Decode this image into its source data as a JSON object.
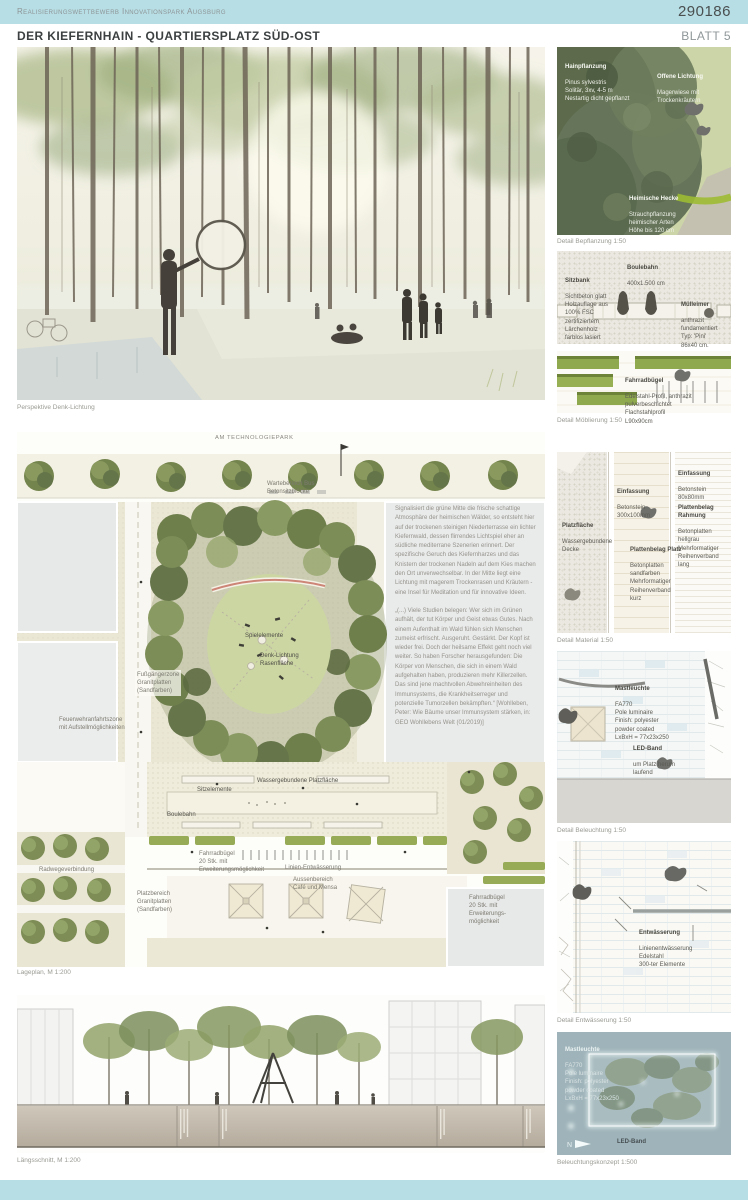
{
  "header": {
    "competition": "Realisierungswettbewerb Innovationspark Augsburg",
    "entry_number": "290186",
    "title": "DER KIEFERNHAIN - QUARTIERSPLATZ SÜD-OST",
    "sheet": "BLATT 5"
  },
  "perspective": {
    "caption": "Perspektive Denk-Lichtung"
  },
  "siteplan": {
    "street_label": "AM TECHNOLOGIEPARK",
    "caption": "Lageplan, M 1:200",
    "labels": {
      "wartebereich": "Wartebereich Bus\nBetonsitzblöcke",
      "spielelemente": "Spielelemente",
      "denklichtung": "Denk-Lichtung\nRasenfläche",
      "fussgaengerzone": "Fußgängerzone\nGranitplatten\n(Sandfarben)",
      "feuerwehr": "Feuerwehranfahrtszone\nmit Aufstellmöglichkeiten",
      "wassergebunden": "Wassergebundene Platzfläche",
      "sitzelemente": "Sitzelemente",
      "boulebahn": "Boulebahn",
      "fahrradbuegel_links": "Fahrradbügel\n20 Stk. mit\nErweiterungsmöglichkeit",
      "linienentwaesserung": "Linien-Entwässerung",
      "aussenbereich": "Aussenbereich\nCafé und Mensa",
      "platzbereich": "Platzbereich\nGranitplatten\n(Sandfarben)",
      "fahrradbuegel_rechts": "Fahrradbügel\n20 Stk. mit\nErweiterungs-\nmöglichkeit",
      "radweg": "Radwegeverbindung"
    },
    "text": {
      "p1": "Signalisiert die grüne Mitte die frische schattige Atmosphäre der heimischen Wälder, so entsteht hier auf der trockenen steinigen Niederterrasse ein lichter Kiefernwald, dessen flirrendes Lichtspiel eher an südliche mediterrane Szenerien erinnert. Der spezifische Geruch des Kiefernharzes und das Knistern der trockenen Nadeln auf dem Kies machen den Ort unverwechselbar. In der Mitte liegt eine Lichtung mit magerem Trockenrasen und Kräutern - eine Insel für Meditation und für innovative Ideen.",
      "p2": "„(...) Viele Studien belegen: Wer sich im Grünen aufhält, der tut Körper und Geist etwas Gutes. Nach einem Aufenthalt im Wald fühlen sich Menschen zumeist erfrischt. Ausgeruht. Gestärkt. Der Kopf ist wieder frei. Doch der heilsame Effekt geht noch viel weiter. So haben Forscher herausgefunden: Die Körper von Menschen, die sich in einem Wald aufgehalten haben, produzieren mehr Killerzellen. Das sind jene machtvollen Abwehreinheiten des Immunsystems, die Krankheitserreger und potenzielle Tumorzellen bekämpften.“ [Wohlleben, Peter: Wie Bäume unser Immunsystem stärken, in: GEO Wohllebens Welt (01/2019)]"
    }
  },
  "section": {
    "caption": "Längsschnitt, M 1:200"
  },
  "details": {
    "bepflanzung": {
      "caption": "Detail Bepflanzung 1:50",
      "hain_title": "Hainpflanzung",
      "hain_body": "Pinus sylvestris\nSolitär, 3xv, 4-5 m\nNestartig dicht gepflanzt",
      "lichtung_title": "Offene Lichtung",
      "lichtung_body": "Magerwiese mit Trockenkräutern",
      "hecke_title": "Heimische Hecke",
      "hecke_body": "Strauchpflanzung\nheimischer Arten\nHöhe bis 120 cm\nPflanzabstand 1,00 m"
    },
    "moeblierung": {
      "caption": "Detail Möblierung 1:50",
      "boule_title": "Boulebahn",
      "boule_body": "400x1.500 cm",
      "sitzbank_title": "Sitzbank",
      "sitzbank_body": "Sichtbeton glatt\nHolzauflage aus\n100% FSC\nzertifiziertem\nLärchenholz\nfarblos lasiert",
      "muell_title": "Mülleimer",
      "muell_body": "anthrazit\nfundamentiert\nTyp: 'Pini'\n86x40 cm.",
      "rad_title": "Fahrradbügel",
      "rad_body": "Edelstahl-Profil, anthrazit\npulverbeschichtet\nFlachstahlprofil\nL90x90cm"
    },
    "material": {
      "caption": "Detail Material 1:50",
      "platz_title": "Platzfläche",
      "platz_body": "Wassergebundene\nDecke",
      "einf1_title": "Einfassung",
      "einf1_body": "Betonstein\n300x100mm",
      "einf2_title": "Einfassung",
      "einf2_body": "Betonstein\n80x80mm",
      "rahmung_title": "Plattenbelag Rahmung",
      "rahmung_body": "Betonplatten\nhellgrau\nMehrformatiger\nReihenverband lang",
      "belag_title": "Plattenbelag Platz",
      "belag_body": "Betonplatten\nsandfarben\nMehrformatiger\nReihenverband kurz"
    },
    "beleuchtung": {
      "caption": "Detail Beleuchtung 1:50",
      "mast_title": "Mastleuchte",
      "mast_body": "FA770\nPole luminaire\nFinish: polyester\npowder coated\nLxBxH = 77x23x250",
      "led_title": "LED-Band",
      "led_body": "um Platz herum\nlaufend"
    },
    "entwaesserung": {
      "caption": "Detail Entwässerung 1:50",
      "title": "Entwässerung",
      "body": "Linienentwässerung\nEdelstahl\n300-ter Elemente"
    },
    "konzept": {
      "caption": "Beleuchtungskonzept 1:500",
      "mast_title": "Mastleuchte",
      "mast_body": "FA770\nPole luminaire\nFinish: polyester\npowder coated\nLxBxH = 77x23x250",
      "led_title": "LED-Band",
      "led_body": "Band als Platzfassung"
    }
  },
  "colors": {
    "accent": "#b7dee4"
  }
}
